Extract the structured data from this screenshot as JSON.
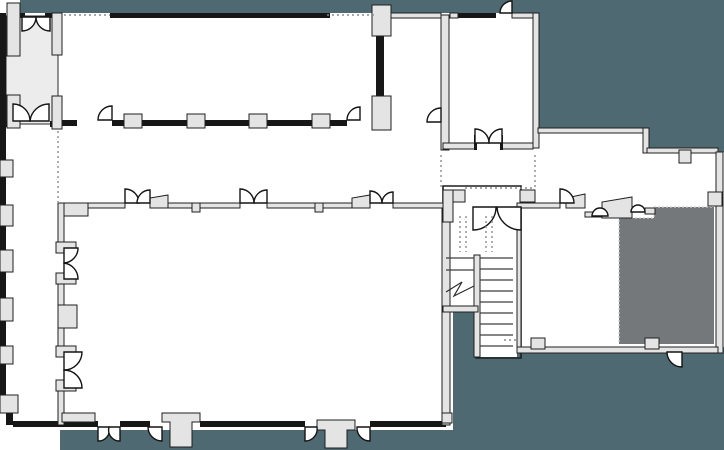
{
  "meta": {
    "drawing_kind": "architectural floor plan, no text labels visible"
  },
  "canvas": {
    "width": 724,
    "height": 450,
    "background": "#ffffff"
  },
  "colors": {
    "exterior": "#4e6971",
    "room_dark": "#75787b",
    "room_light": "#ececec",
    "wall_fill": "#e4e4e4",
    "wall_black": "#171717",
    "door_fill": "#ffffff",
    "dashed_line": "#8c8c8c",
    "tread_line": "#3f3f3f"
  },
  "regions": [
    {
      "id": "exterior-top-band"
    },
    {
      "id": "exterior-right-block"
    },
    {
      "id": "exterior-bottom-right"
    },
    {
      "id": "entry-vestibule"
    },
    {
      "id": "upper-hall"
    },
    {
      "id": "top-room-a"
    },
    {
      "id": "top-room-b"
    },
    {
      "id": "central-corridor"
    },
    {
      "id": "left-corridor"
    },
    {
      "id": "lower-hall"
    },
    {
      "id": "stairwell"
    },
    {
      "id": "right-wing-room"
    },
    {
      "id": "dark-room"
    }
  ],
  "stairs": {
    "flights": 2,
    "treads_right_flight": 9,
    "treads_left_flight": 2,
    "landing_double_door": true
  },
  "doors": {
    "double_swing_doors": 10,
    "single_swing_doors": 10
  },
  "dashed_reference_lines": 10
}
